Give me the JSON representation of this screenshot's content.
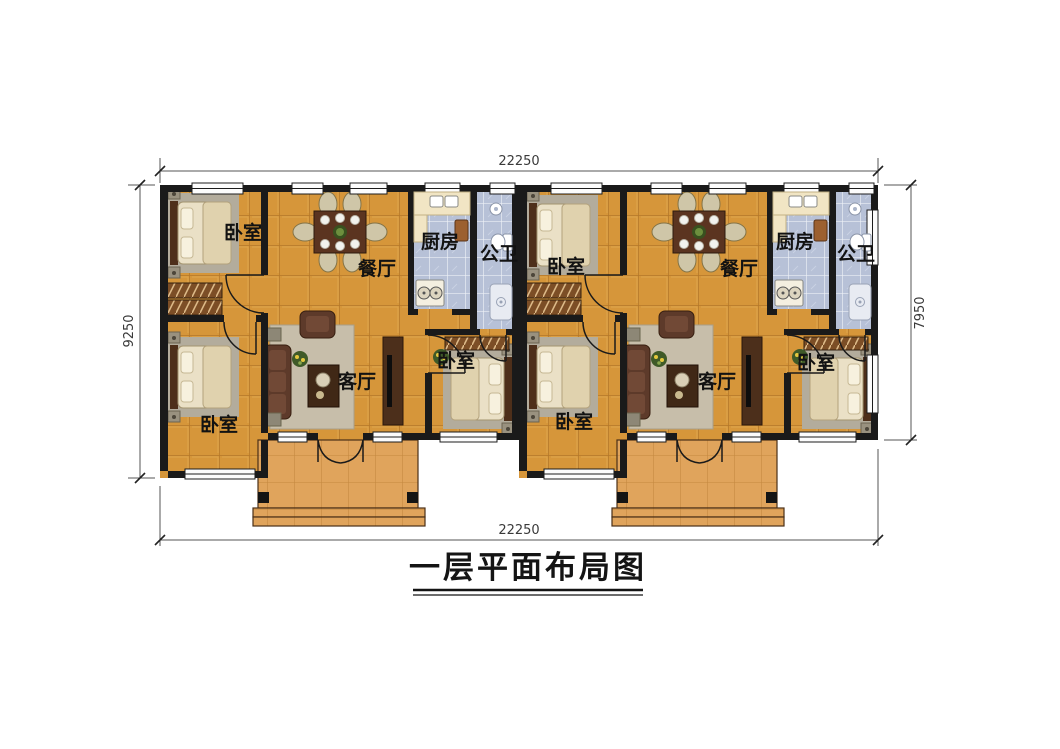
{
  "title": "一层平面布局图",
  "dimensions": {
    "top_width": "22250",
    "bottom_width": "22250",
    "left_height": "9250",
    "right_height": "7950"
  },
  "units": [
    {
      "id": "left",
      "rooms": [
        {
          "key": "bedroom-nw",
          "label": "卧室"
        },
        {
          "key": "dining",
          "label": "餐厅"
        },
        {
          "key": "kitchen",
          "label": "厨房"
        },
        {
          "key": "bathroom",
          "label": "公卫"
        },
        {
          "key": "bedroom-sw",
          "label": "卧室"
        },
        {
          "key": "living",
          "label": "客厅"
        },
        {
          "key": "bedroom-se",
          "label": "卧室"
        }
      ]
    },
    {
      "id": "right",
      "rooms": [
        {
          "key": "bedroom-nw",
          "label": "卧室"
        },
        {
          "key": "dining",
          "label": "餐厅"
        },
        {
          "key": "kitchen",
          "label": "厨房"
        },
        {
          "key": "bathroom",
          "label": "公卫"
        },
        {
          "key": "bedroom-sw",
          "label": "卧室"
        },
        {
          "key": "living",
          "label": "客厅"
        },
        {
          "key": "bedroom-se",
          "label": "卧室"
        }
      ]
    }
  ],
  "colors": {
    "wall": "#1a1a1a",
    "floor_tile": "#d6963a",
    "wet_room_tile": "#b7c1d7",
    "porch_tile": "#e0a45c",
    "dimension_line": "#555555",
    "text": "#141414"
  }
}
